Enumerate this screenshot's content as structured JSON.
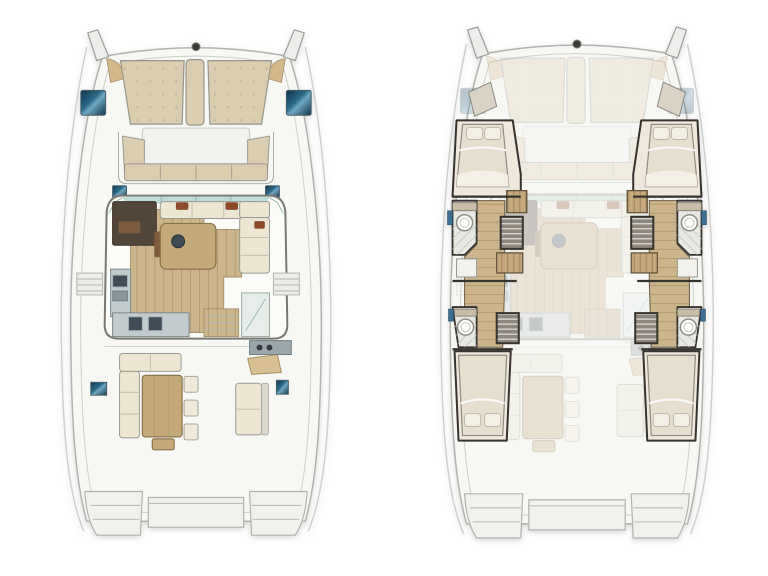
{
  "diagram": {
    "kind": "catamaran-yacht-floorplan",
    "views": [
      {
        "id": "main-deck-plan",
        "side": "left",
        "features": [
          "bow-sunpads",
          "anchor-windlass",
          "deck-hatches",
          "forward-cockpit-seating",
          "saloon",
          "chart-table",
          "dinette-sofa",
          "saloon-table",
          "galley",
          "entry-steps",
          "side-boarding-steps",
          "aft-cockpit-sofa",
          "cockpit-table",
          "cockpit-stools",
          "aft-bench",
          "wet-bar",
          "hull-windows",
          "swim-platforms"
        ]
      },
      {
        "id": "lower-deck-plan",
        "side": "right",
        "features": [
          "ghosted-main-deck",
          "port-forward-cabin",
          "port-bathroom",
          "port-shower",
          "port-stairs",
          "port-wardrobe",
          "port-aft-cabin",
          "starboard-forward-cabin",
          "starboard-bathroom",
          "starboard-shower",
          "starboard-stairs",
          "starboard-wardrobe",
          "starboard-aft-cabin",
          "hull-windows",
          "swim-platforms"
        ]
      }
    ],
    "palette": {
      "page_bg": "#ffffff",
      "hull_fill": "#f7f7f4",
      "hull_stroke": "#b3b3ae",
      "deck_line": "#cfcfca",
      "cushion_beige": "#dbcdaf",
      "cushion_cream": "#ece6d3",
      "cushion_border": "#96968c",
      "corner_tan": "#d3b88b",
      "wood_floor": "#ccb48c",
      "wood_line": "#b29a72",
      "wood_table": "#c4a97a",
      "dark_counter": "#52453a",
      "galley_gray": "#c2ccce",
      "appliance_dark": "#404c56",
      "wall_dark": "#37332e",
      "tile_light": "#e9e9e4",
      "bed_duvet": "#e6dfcf",
      "bed_pillow": "#f3efe4",
      "wardrobe_tan": "#c7a97f",
      "wardrobe_line": "#9d8257",
      "hatch_blue_deep": "#11344a",
      "hatch_blue_mid": "#2d6a8a",
      "hatch_blue_light": "#6fa7c0",
      "glass_teal": "#bedcd6",
      "platform_fill": "#f1f1ee",
      "slat_gray": "#8d877d",
      "slat_line": "#e9e7e1",
      "bath_blue": "#3c6f92",
      "ghost_opacity": "0.27"
    }
  }
}
